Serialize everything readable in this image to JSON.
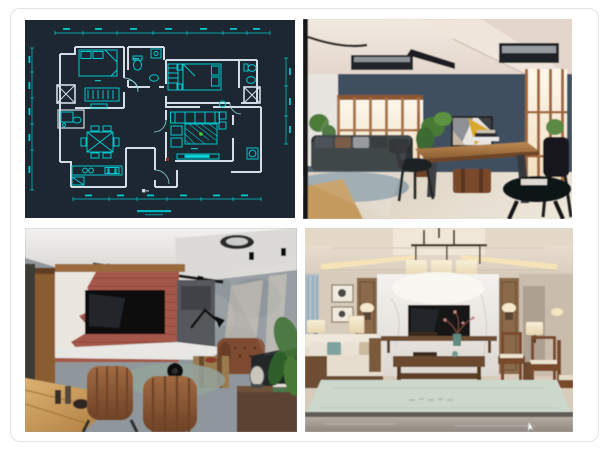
{
  "page": {
    "background": "#ffffff",
    "card_border": "#e3e3e3"
  },
  "collage": {
    "gap_color": "#ffffff",
    "quadrants": [
      {
        "id": "cad-floor-plan",
        "kind": "cad-drawing",
        "bg": "#1c2732",
        "line_color": "#00c9ce",
        "wall_color": "#d3dde6",
        "accent_green": "#46c838",
        "accent_red": "#8a2a22"
      },
      {
        "id": "loft-living-room-photo",
        "kind": "photo",
        "wall": "#41505f",
        "ceiling": "#ece2d8",
        "window_glow": "#f9eed9",
        "window_frame": "#a2663a",
        "floor": "#e2d8c8",
        "art_yellow": "#d9a827"
      },
      {
        "id": "industrial-living-room-photo",
        "kind": "photo",
        "brick": "#a5584a",
        "concrete": "#8f979c",
        "ceiling": "#e9e8e5",
        "bar_wood": "#c99e5c",
        "leather": "#8a5736"
      },
      {
        "id": "new-chinese-living-room-photo",
        "kind": "photo",
        "wall": "#d7cbbc",
        "marble": "#edeae7",
        "wood": "#8a6a48",
        "rug": "#cdd8cd",
        "lamp_glow": "#f6e9cc",
        "tv": "#141517"
      }
    ]
  }
}
